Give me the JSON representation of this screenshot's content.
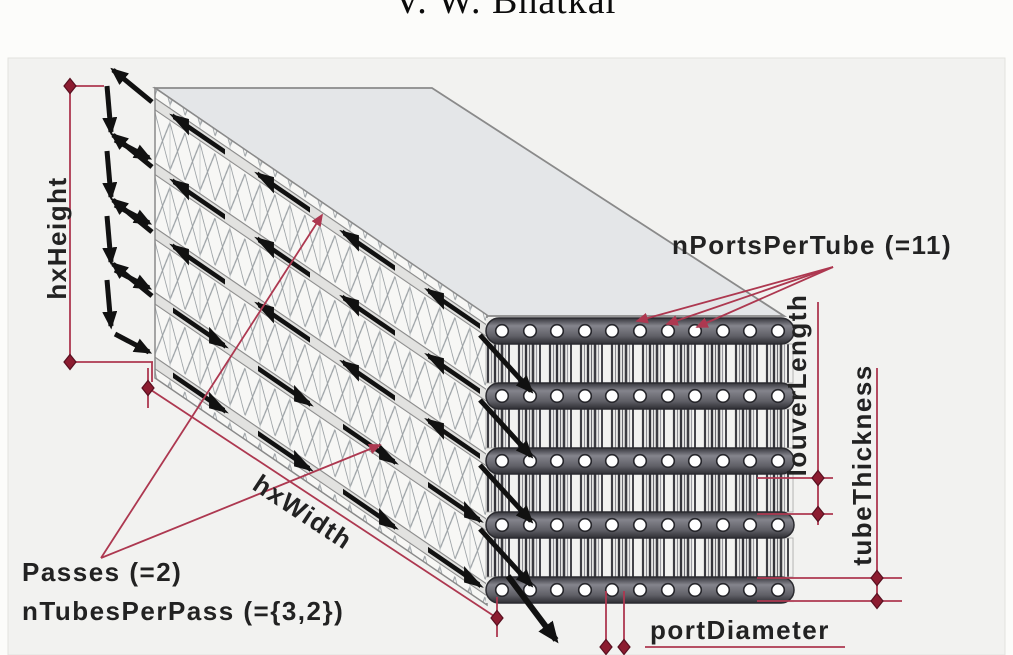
{
  "header": {
    "author": "V. W. Bhatkar"
  },
  "figure": {
    "description": "Isometric schematic of a louvered-fin flat-tube heat exchanger with geometric parameter annotations",
    "labels": {
      "hx_height": "hxHeight",
      "hx_width": "hxWidth",
      "n_ports_per_tube": "nPortsPerTube (=11)",
      "louver_length": "louverLength",
      "tube_thickness": "tubeThickness",
      "passes": "Passes (=2)",
      "n_tubes_per_pass": "nTubesPerPass (={3,2})",
      "port_diameter": "portDiameter"
    },
    "values": {
      "n_ports_per_tube": 11,
      "n_passes": 2,
      "tubes_per_pass": "{3,2}",
      "n_tubes_total": 5
    },
    "colors": {
      "dimension_line": "#ad3850",
      "marker_fill": "#8c1c30",
      "marker_stroke": "#581020",
      "label_text": "#222222",
      "arrow_black": "#111111",
      "top_face": "#e4e6e8",
      "figure_bg": "#f2f2f0",
      "page_bg": "#fcfcfa"
    }
  }
}
